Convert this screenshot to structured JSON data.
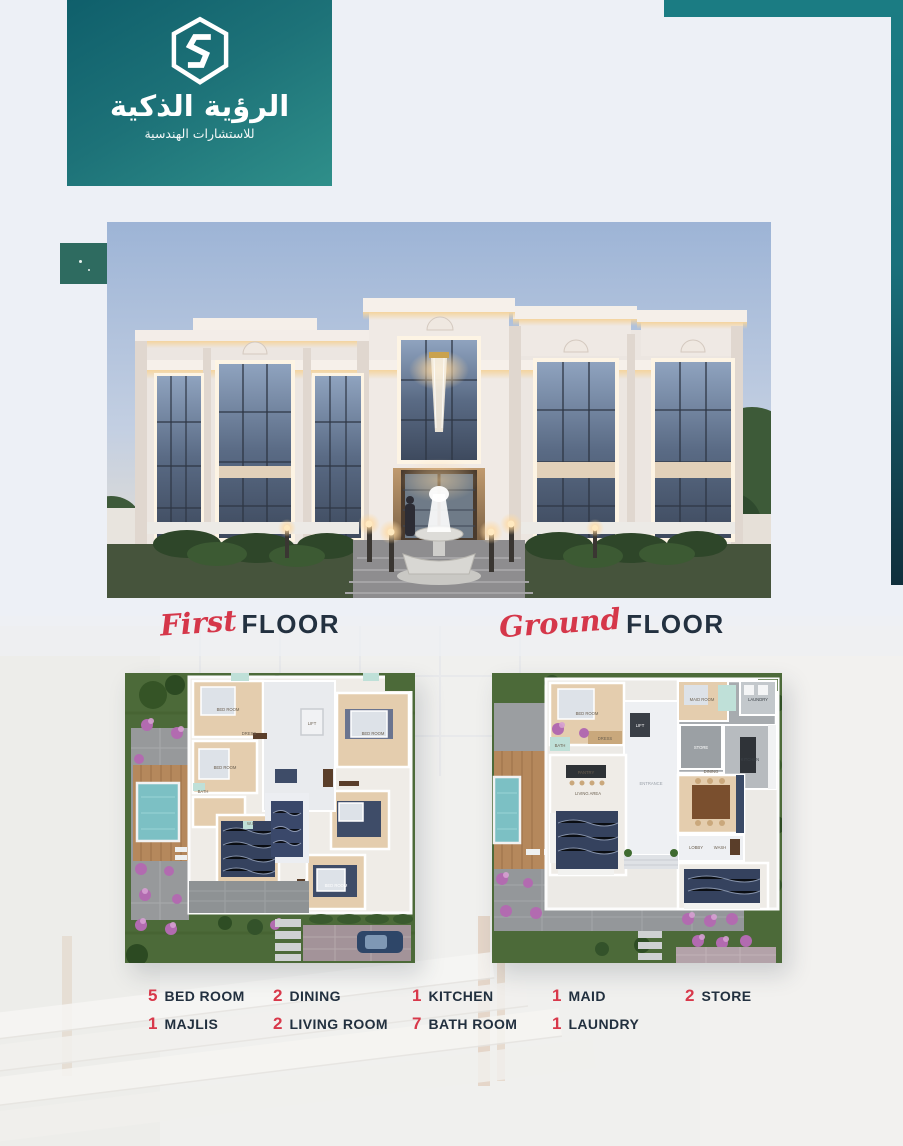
{
  "poster": {
    "background": "#edf0f6",
    "accent_teal": "#1b7c83",
    "accent_red": "#d8384a",
    "text_navy": "#22303f"
  },
  "logo": {
    "title": "الرؤية الذكية",
    "subtitle": "للاستشارات الهندسية",
    "icon": "hexagon-s-logo"
  },
  "floor_sections": {
    "first": {
      "script_word": "First",
      "title_word": "FLOOR"
    },
    "ground": {
      "script_word": "Ground",
      "title_word": "FLOOR"
    }
  },
  "legend": {
    "items": [
      {
        "count": "5",
        "label": "BED ROOM"
      },
      {
        "count": "2",
        "label": "DINING"
      },
      {
        "count": "1",
        "label": "KITCHEN"
      },
      {
        "count": "1",
        "label": "MAID"
      },
      {
        "count": "2",
        "label": "STORE"
      },
      {
        "count": "1",
        "label": "MAJLIS"
      },
      {
        "count": "2",
        "label": "LIVING ROOM"
      },
      {
        "count": "7",
        "label": "BATH ROOM"
      },
      {
        "count": "1",
        "label": "LAUNDRY"
      }
    ]
  },
  "plans": {
    "first_floor": {
      "labels": [
        "BED ROOM",
        "BED ROOM",
        "BED ROOM",
        "BED ROOM",
        "BATH",
        "DRESS",
        "W.C",
        "LIFT"
      ]
    },
    "ground_floor": {
      "labels": [
        "BED ROOM",
        "BATH",
        "DRESS",
        "MAID ROOM",
        "LAUNDRY",
        "LIFT",
        "STORE",
        "KITCHEN",
        "PANTRY",
        "ENTRANCE",
        "LIVING AREA",
        "DINING",
        "LOBBY",
        "WASH"
      ]
    }
  }
}
